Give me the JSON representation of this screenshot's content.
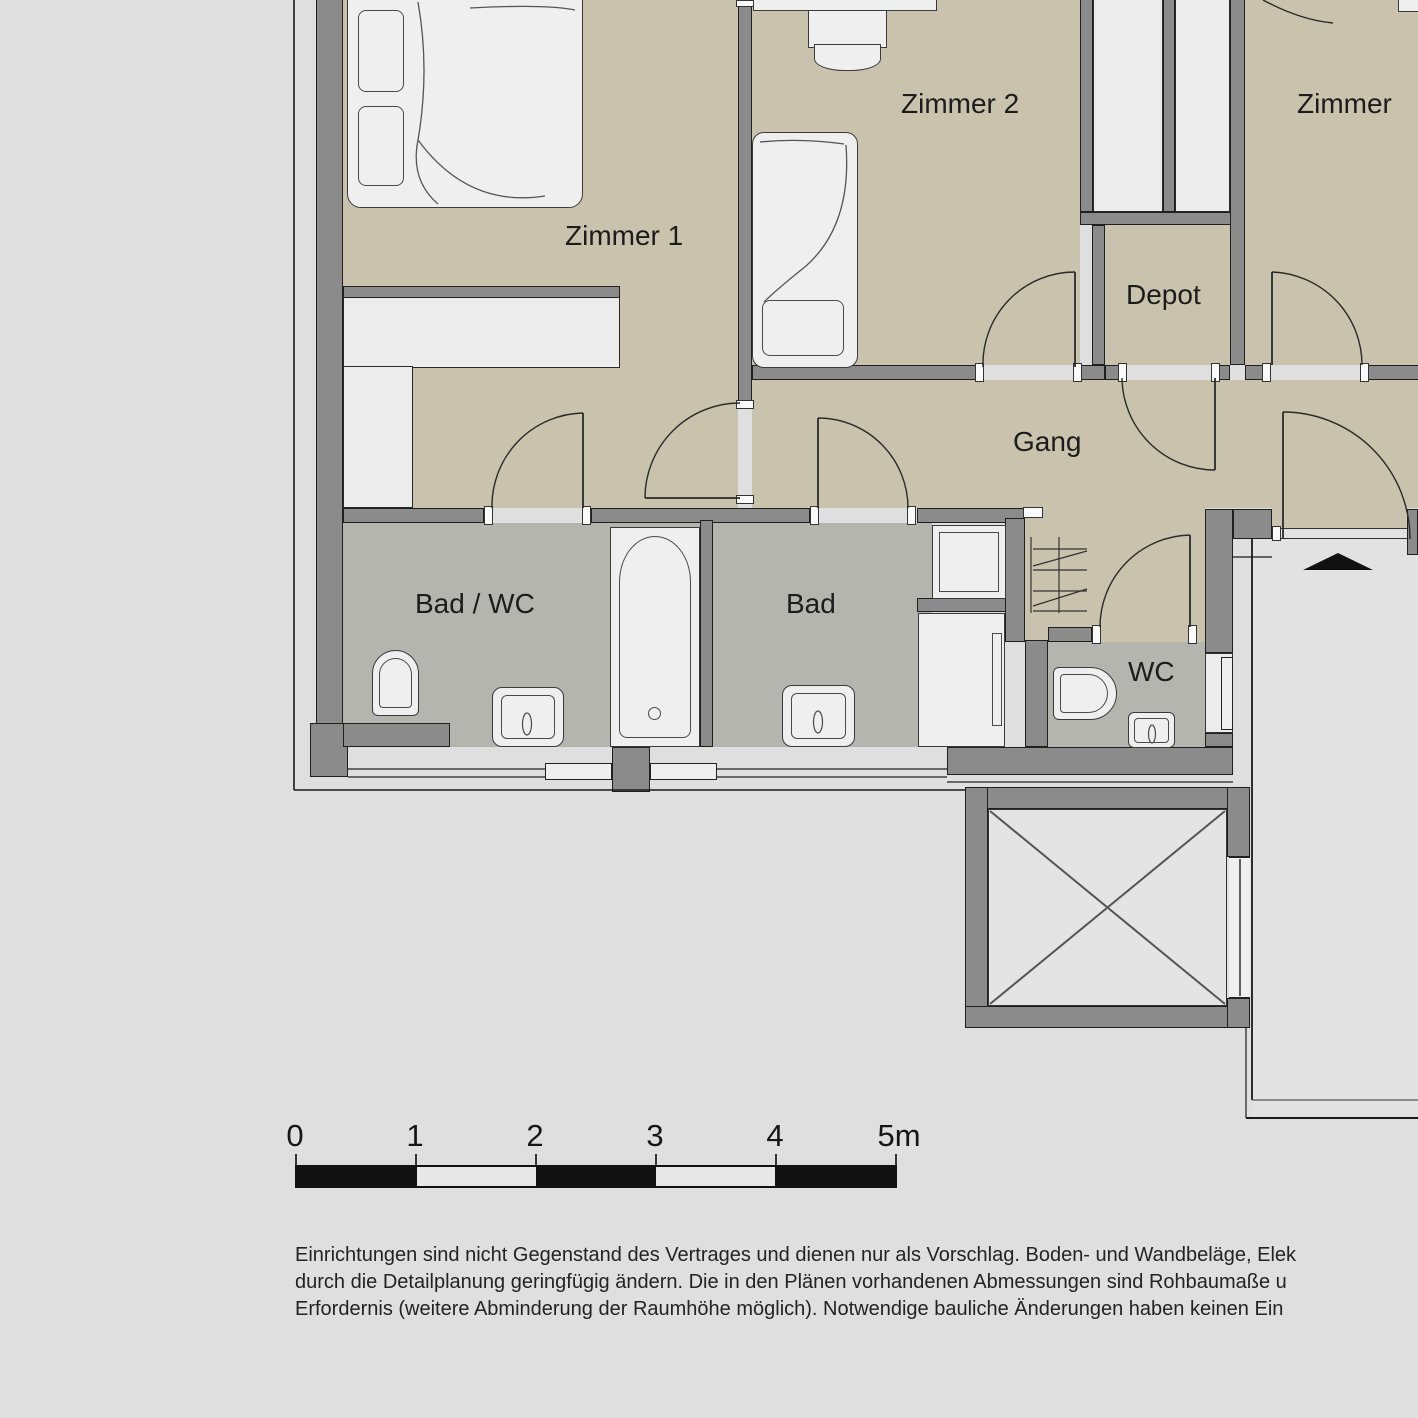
{
  "rooms": {
    "zimmer1": {
      "label": "Zimmer 1"
    },
    "zimmer2": {
      "label": "Zimmer 2"
    },
    "zimmer3": {
      "label": "Zimmer"
    },
    "depot": {
      "label": "Depot"
    },
    "gang": {
      "label": "Gang"
    },
    "bad_wc": {
      "label": "Bad / WC"
    },
    "bad": {
      "label": "Bad"
    },
    "wc": {
      "label": "WC"
    }
  },
  "scale_bar": {
    "unit_labels": [
      "0",
      "1",
      "2",
      "3",
      "4",
      "5m"
    ]
  },
  "disclaimer": {
    "lines": [
      "Einrichtungen sind nicht Gegenstand des Vertrages und dienen nur als Vorschlag. Boden- und Wandbeläge, Elek",
      "durch die Detailplanung geringfügig ändern. Die in den Plänen vorhandenen Abmessungen sind Rohbaumaße u",
      "Erfordernis (weitere Abminderung der Raumhöhe möglich). Notwendige bauliche Änderungen haben keinen Ein"
    ]
  },
  "colors": {
    "bg": "#dfdfdf",
    "beige": "#c9c2ac",
    "bath": "#b5b5af",
    "wall": "#8b8b8b",
    "outline": "#1f1f1f",
    "fixture": "#efefef",
    "shaft": "#ececec",
    "landing": "#e2e2e2",
    "text": "#1c1c1c"
  }
}
